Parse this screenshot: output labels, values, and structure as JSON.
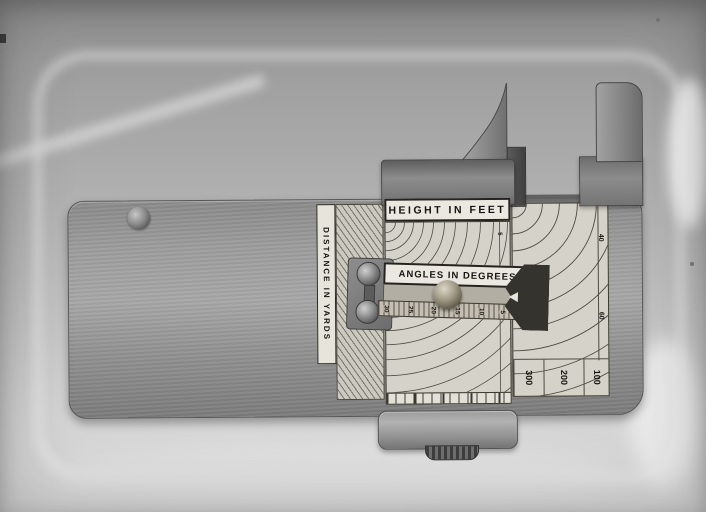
{
  "scene": {
    "type": "black-and-white photograph on glass plate with chemical stains",
    "subject": "brass rangefinder slide-rule instrument viewed from above"
  },
  "instrument": {
    "height_scale_label": "HEIGHT IN FEET",
    "angles_scale_label": "ANGLES IN DEGREES",
    "distance_scale_label": "DISTANCE IN YARDS",
    "distance_left_value": "700",
    "distance_bottom_values": [
      "300",
      "200",
      "100"
    ],
    "height_edge_values": [
      "40",
      "60"
    ],
    "window_edge_value": "5",
    "angle_scale": {
      "ticks": [
        "30",
        "25",
        "20",
        "15",
        "10",
        "5",
        "0"
      ]
    },
    "colors": {
      "backdrop_top": "#8f8f8f",
      "backdrop_bottom": "#dbdbdb",
      "plate_metal": "#9d9d9d",
      "chart_face": "#d5d2c9",
      "label_face": "#ebe8e1",
      "engraving_line": "#4e4b42",
      "engraving_text": "#16140f",
      "brass_knob": "#a39c88",
      "pointer_dark": "#35332e"
    }
  }
}
